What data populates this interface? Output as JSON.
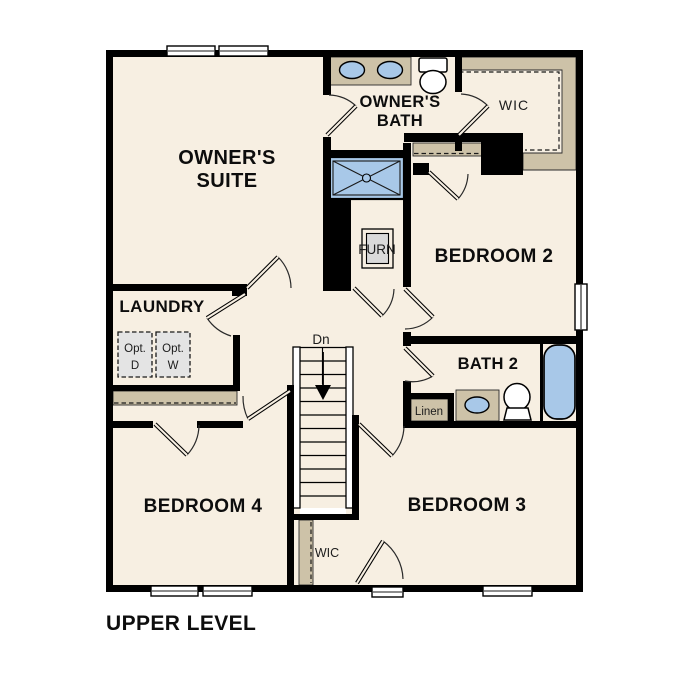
{
  "plan_title": "UPPER LEVEL",
  "colors": {
    "floor": "#f7efe2",
    "wall": "#000000",
    "casework_tan": "#cdc2a8",
    "fixture_blue": "#a8c8e8",
    "appliance_gray": "#e4e4e4",
    "background": "#ffffff"
  },
  "rooms": {
    "owners_suite": {
      "line1": "OWNER'S",
      "line2": "SUITE"
    },
    "owners_bath": {
      "line1": "OWNER'S",
      "line2": "BATH"
    },
    "wic_upper": {
      "label": "WIC"
    },
    "bedroom_2": {
      "label": "BEDROOM 2"
    },
    "furnace": {
      "label": "FURN"
    },
    "laundry": {
      "label": "LAUNDRY",
      "opt_dryer_line1": "Opt.",
      "opt_dryer_line2": "D",
      "opt_washer_line1": "Opt.",
      "opt_washer_line2": "W"
    },
    "stairs": {
      "label": "Dn"
    },
    "bath_2": {
      "label": "BATH 2",
      "linen_label": "Linen"
    },
    "bedroom_3": {
      "label": "BEDROOM 3"
    },
    "bedroom_4": {
      "label": "BEDROOM 4"
    },
    "wic_lower": {
      "label": "WIC"
    }
  }
}
